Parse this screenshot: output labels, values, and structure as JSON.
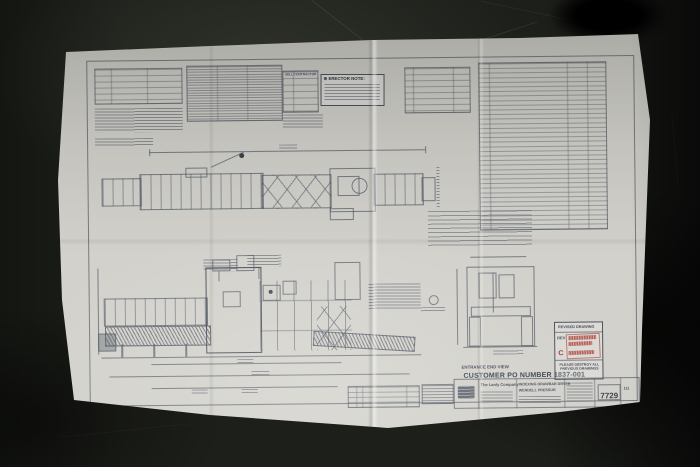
{
  "notes": {
    "erector_note_symbol": "⊕",
    "erector_note_title": "ERECTOR NOTE:"
  },
  "tables": {
    "mill_contractor_title": "MILL CONTRACTOR"
  },
  "stamp": {
    "title": "REVISED DRAWING",
    "rev_label": "REV",
    "rev_value": "C",
    "warning": "PLEASE DESTROY ALL PREVIOUS DRAWINGS",
    "color": "#a63a32"
  },
  "views": {
    "entrance_end_view_label": "ENTRANCE END VIEW",
    "customer_po": "CUSTOMER PO NUMBER 1837-001"
  },
  "title_block": {
    "company": "The Lanly Company",
    "title_line1": "INDEXING DRAWBAR DRYER",
    "title_line2": "WENDELL PRESSUR",
    "drawing_number": "7729",
    "sheet": "1/1"
  },
  "colors": {
    "paper": "#d2d1cb",
    "ink": "#585e6a",
    "floor": "#1d1f1a",
    "stamp_red": "#a63a32"
  }
}
